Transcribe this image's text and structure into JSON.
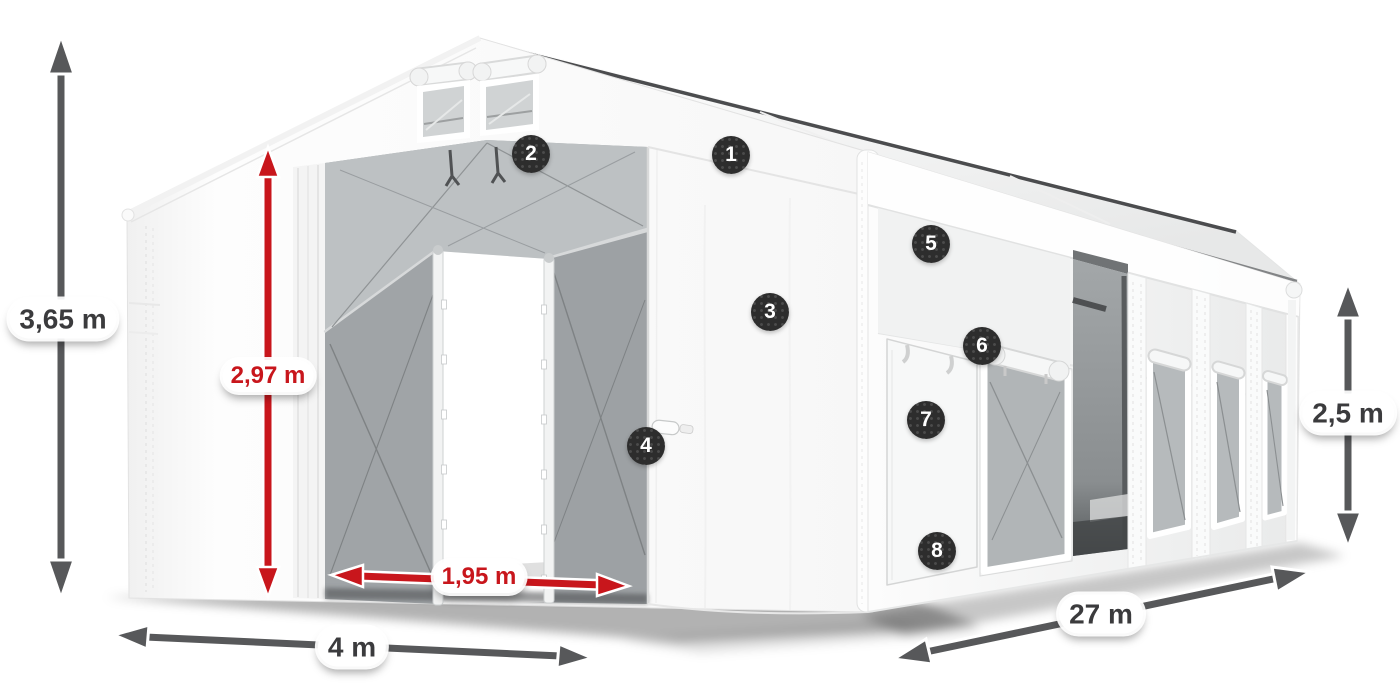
{
  "figure_title": "Storage tent with dimension callouts",
  "dimensions": {
    "height_total": "3,65 m",
    "height_inner": "2,97 m",
    "door_width": "1,95 m",
    "front_width": "4 m",
    "length": "27 m",
    "side_height": "2,5 m"
  },
  "markers": [
    {
      "label": "1"
    },
    {
      "label": "2"
    },
    {
      "label": "3"
    },
    {
      "label": "4"
    },
    {
      "label": "5"
    },
    {
      "label": "6"
    },
    {
      "label": "7"
    },
    {
      "label": "8"
    }
  ],
  "colors": {
    "accent_red": "#c8161c",
    "dimension_gray": "#57585a",
    "marker_bg": "#2d2d2d",
    "tent_white": "#ffffff",
    "mesh_gray": "#a6aaac"
  }
}
